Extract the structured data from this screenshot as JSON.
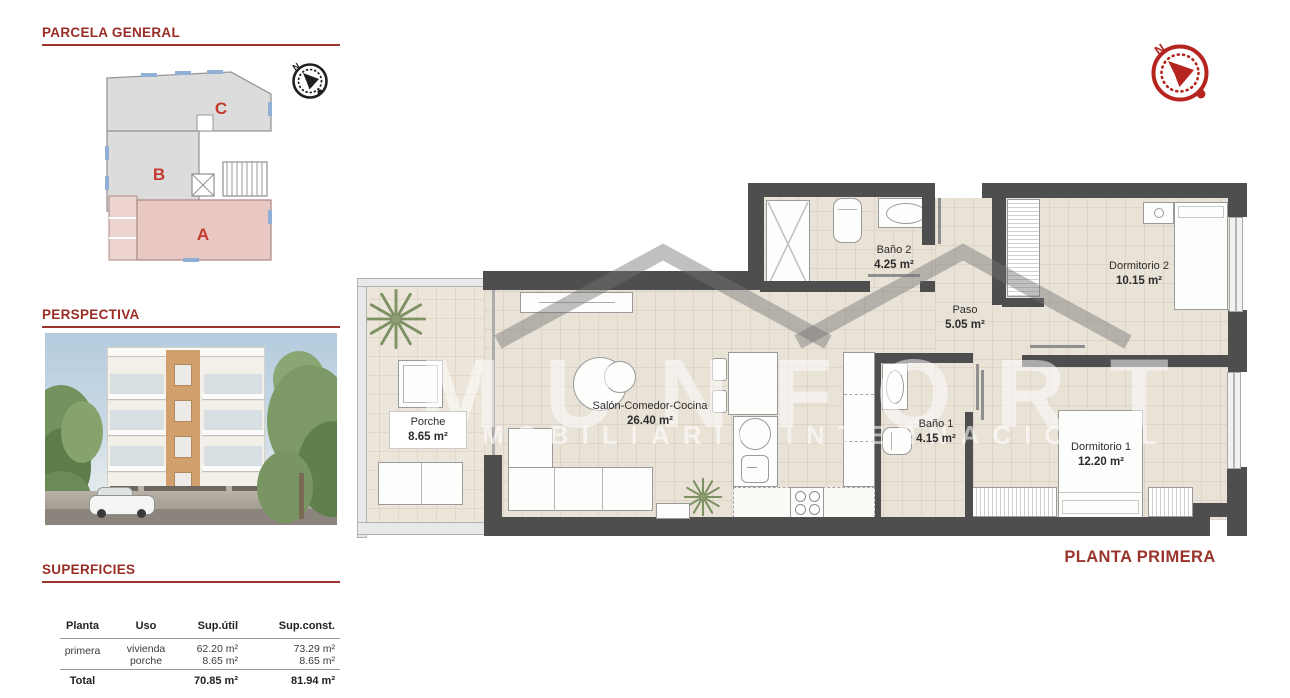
{
  "parcela": {
    "title": "PARCELA GENERAL",
    "units": {
      "a": "A",
      "b": "B",
      "c": "C"
    }
  },
  "perspectiva": {
    "title": "PERSPECTIVA"
  },
  "superficies": {
    "title": "SUPERFICIES",
    "table": {
      "headers": [
        "Planta",
        "Uso",
        "Sup.útil",
        "Sup.const."
      ],
      "row": {
        "planta": "primera",
        "uso1": "vivienda",
        "uso2": "porche",
        "util1": "62.20 m²",
        "util2": "8.65 m²",
        "const1": "73.29 m²",
        "const2": "8.65 m²"
      },
      "total": {
        "label": "Total",
        "util": "70.85 m²",
        "const": "81.94 m²"
      }
    }
  },
  "plan": {
    "title": "PLANTA PRIMERA",
    "compass_n": "N",
    "rooms": [
      {
        "name": "Porche",
        "area": "8.65 m²"
      },
      {
        "name": "Salón-Comedor-Cocina",
        "area": "26.40 m²"
      },
      {
        "name": "Baño 2",
        "area": "4.25 m²"
      },
      {
        "name": "Paso",
        "area": "5.05 m²"
      },
      {
        "name": "Dormitorio 2",
        "area": "10.15 m²"
      },
      {
        "name": "Baño 1",
        "area": "4.15 m²"
      },
      {
        "name": "Dormitorio 1",
        "area": "12.20 m²"
      }
    ]
  },
  "watermark": {
    "brand": "MUNFORT",
    "tagline": "INMOBILIARIA INTERNACIONAL"
  },
  "colors": {
    "accent": "#9a342c",
    "wall": "#4e4e4e",
    "floor": "#e9e2d7",
    "unit_a_fill": "#e9c8c3",
    "unit_bc_fill": "#dcdcdc",
    "compass_red": "#b5241e",
    "parcela_letter_red": "#c23b2e"
  }
}
